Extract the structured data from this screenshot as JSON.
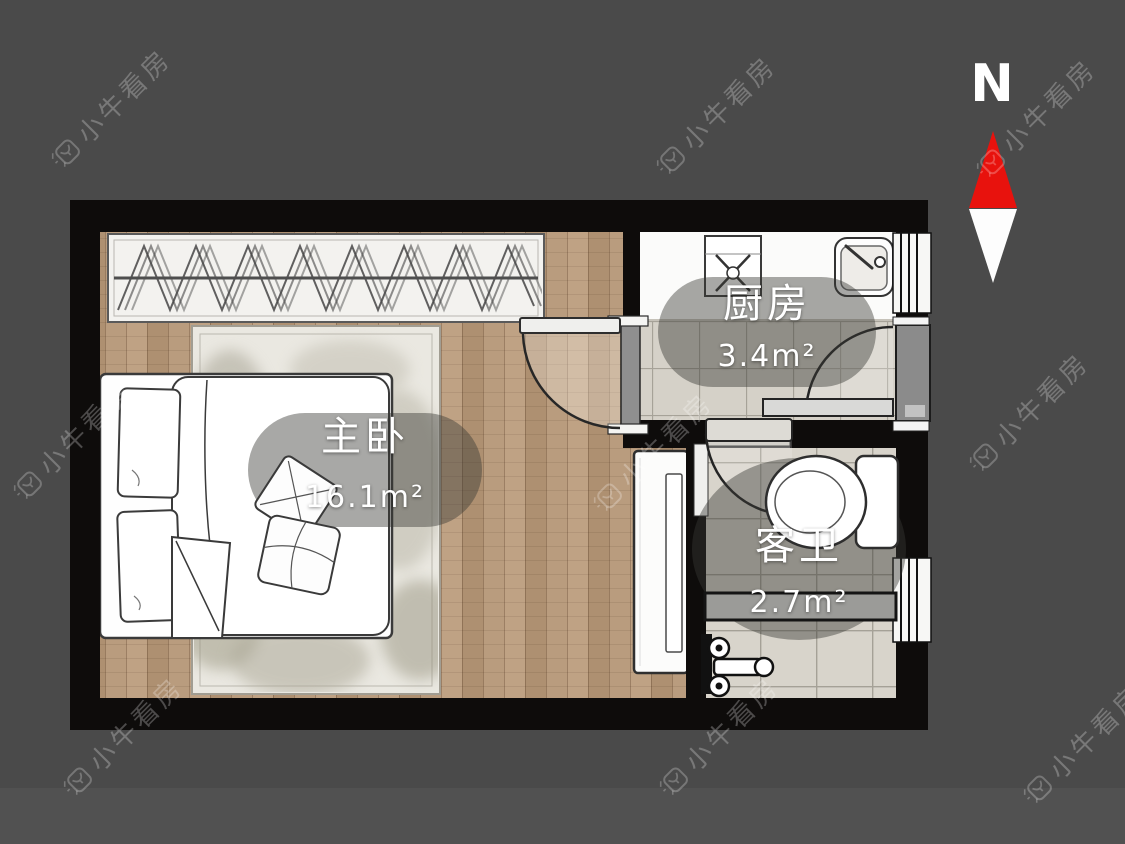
{
  "compass": {
    "label": "N",
    "needle_color": "#e8120d"
  },
  "watermark": {
    "text": "小牛看房"
  },
  "rooms": [
    {
      "name": "主卧",
      "area": "16.1m²"
    },
    {
      "name": "厨房",
      "area": "3.4m²"
    },
    {
      "name": "客卫",
      "area": "2.7m²"
    }
  ],
  "colors": {
    "background": "#4a4a4a",
    "wall": "#0e0c0b",
    "wood_floor": "#b5987a",
    "tile_floor": "#d6d2c9",
    "label_pill": "rgba(56,56,53,0.44)",
    "label_text": "#ffffff"
  }
}
